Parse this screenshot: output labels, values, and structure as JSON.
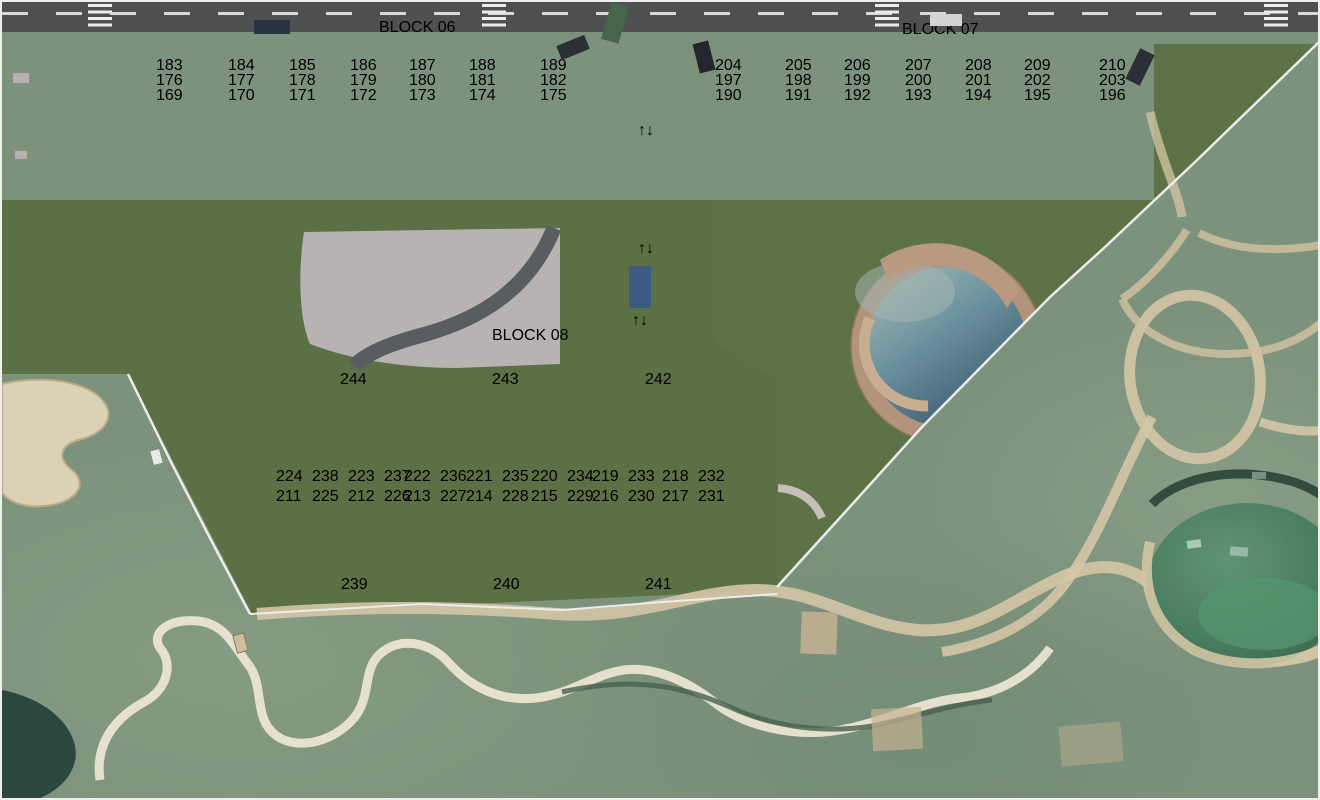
{
  "blocks": {
    "block06": {
      "title": "BLOCK 06",
      "rows": [
        [
          "183",
          "184",
          "185",
          "186",
          "187",
          "188",
          "189"
        ],
        [
          "176",
          "177",
          "178",
          "179",
          "180",
          "181",
          "182"
        ],
        [
          "169",
          "170",
          "171",
          "172",
          "173",
          "174",
          "175"
        ]
      ]
    },
    "block07": {
      "title": "BLOCK 07",
      "rows": [
        [
          "204",
          "205",
          "206",
          "207",
          "208",
          "209",
          "210"
        ],
        [
          "197",
          "198",
          "199",
          "200",
          "201",
          "202",
          "203"
        ],
        [
          "190",
          "191",
          "192",
          "193",
          "194",
          "195",
          "196"
        ]
      ]
    },
    "block08": {
      "title": "BLOCK 08",
      "top": [
        "244",
        "243",
        "242"
      ],
      "upper_pairs": [
        [
          "224",
          "238"
        ],
        [
          "223",
          "237"
        ],
        [
          "222",
          "236"
        ],
        [
          "221",
          "235"
        ],
        [
          "220",
          "234"
        ],
        [
          "219",
          "233"
        ],
        [
          "218",
          "232"
        ]
      ],
      "lower_pairs": [
        [
          "211",
          "225"
        ],
        [
          "212",
          "226"
        ],
        [
          "213",
          "227"
        ],
        [
          "214",
          "228"
        ],
        [
          "215",
          "229"
        ],
        [
          "216",
          "230"
        ],
        [
          "217",
          "231"
        ]
      ],
      "bottom": [
        "239",
        "240",
        "241"
      ]
    }
  },
  "colors": {
    "chip_text": "#a32834",
    "chip_bg": "#f8f6f1",
    "title_text": "#9c2130",
    "golf_green": "#7c927c",
    "lawn_green": "#5c7146",
    "deck_brown": "#8c795c",
    "road_asphalt": "#4f5052",
    "pool_water": "#4a7383",
    "sand": "#dbd1b6"
  }
}
